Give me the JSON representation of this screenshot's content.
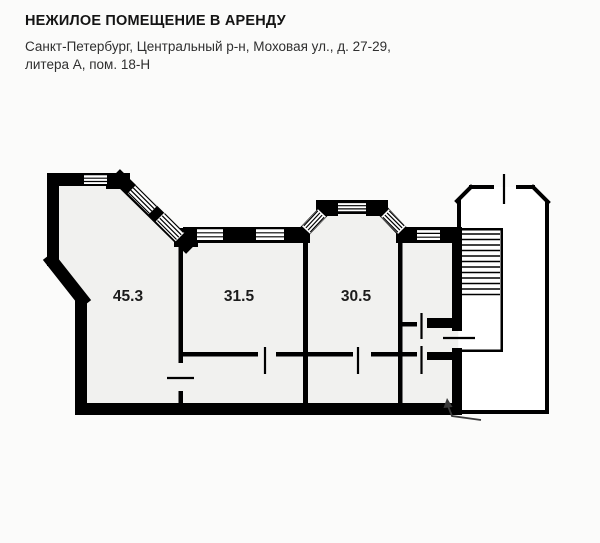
{
  "header": {
    "title": "НЕЖИЛОЕ ПОМЕЩЕНИЕ В АРЕНДУ",
    "address_line1": "Санкт-Петербург, Центральный р-н, Моховая ул., д. 27-29,",
    "address_line2": "литера А, пом. 18-Н"
  },
  "plan": {
    "rooms": [
      {
        "name": "room-left",
        "area_label": "45.3"
      },
      {
        "name": "room-middle",
        "area_label": "31.5"
      },
      {
        "name": "room-right",
        "area_label": "30.5"
      }
    ],
    "features": {
      "staircase": "stair flight with treads in right-side stairwell",
      "entrance_arrow": "entry from stair landing",
      "windows": "window bands on north facade and bay window",
      "doors": "gap-and-tick door symbols"
    },
    "colors": {
      "wall": "#000000",
      "room_fill": "#f1f1ef",
      "stairwell_fill": "#ffffff",
      "page_bg": "#fbfbfa",
      "arrow": "#3a3a3a"
    }
  }
}
